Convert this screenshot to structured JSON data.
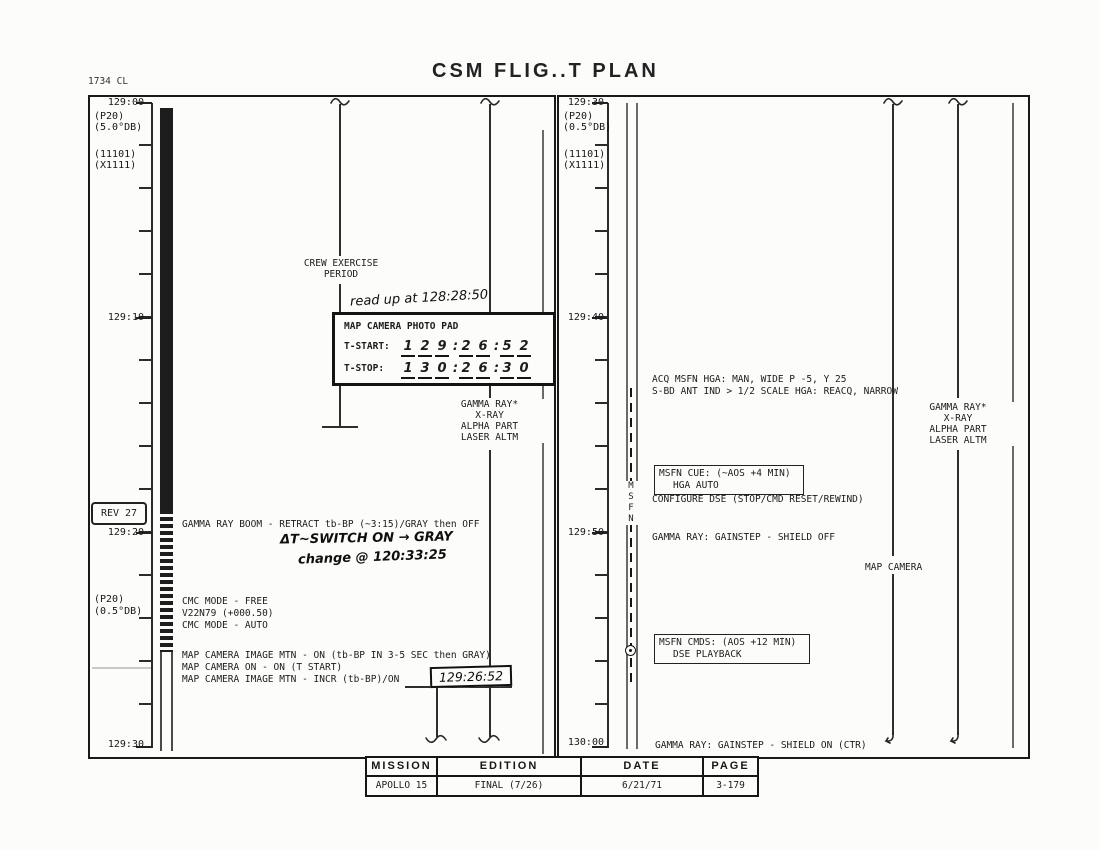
{
  "colors": {
    "ink": "#1c1c1c",
    "paper": "#fcfcfa"
  },
  "header": {
    "corner_code": "1734 CL",
    "title": "CSM FLIG..T PLAN"
  },
  "left_panel": {
    "time_labels": [
      "129:00",
      "129:10",
      "129:20",
      "129:30"
    ],
    "top_codes": [
      "(P20)",
      "(5.0°DB)",
      "(11101)",
      "(X1111)"
    ],
    "bottom_codes": [
      "(P20)",
      "(0.5°DB)"
    ],
    "rev_badge": "REV 27",
    "crew_exercise_lines": [
      "CREW EXERCISE",
      "PERIOD"
    ],
    "hw_read_up": "read up at 128:28:50",
    "photo_pad": {
      "title": "MAP CAMERA PHOTO PAD",
      "t_start_label": "T-START:",
      "t_stop_label": "T-STOP:",
      "t_start": [
        "1",
        "2",
        "9",
        ":",
        "2",
        "6",
        ":",
        "5",
        "2"
      ],
      "t_stop": [
        "1",
        "3",
        "0",
        ":",
        "2",
        "6",
        ":",
        "3",
        "0"
      ]
    },
    "instruments": [
      "GAMMA RAY*",
      "X-RAY",
      "ALPHA PART",
      "LASER ALTM"
    ],
    "gamma_boom_line": "GAMMA RAY BOOM - RETRACT tb-BP (~3:15)/GRAY then OFF",
    "hw_switch_note": "ΔT~SWITCH ON → GRAY",
    "hw_change_note": "change @ 120:33:25",
    "cmc_lines": [
      "CMC MODE - FREE",
      "V22N79 (+000.50)",
      "CMC MODE - AUTO"
    ],
    "map_camera_lines": [
      "MAP CAMERA IMAGE MTN - ON (tb-BP IN 3-5 SEC then GRAY)",
      "MAP CAMERA ON - ON (T START)",
      "MAP CAMERA IMAGE MTN - INCR (tb-BP)/ON"
    ],
    "hw_incr_time": "129:26:52"
  },
  "right_panel": {
    "time_labels": [
      "129:30",
      "129:40",
      "129:50",
      "130:00"
    ],
    "top_codes": [
      "(P20)",
      "(0.5°DB)",
      "(11101)",
      "(X1111)"
    ],
    "msfn_letters": [
      "M",
      "S",
      "F",
      "N"
    ],
    "acq_lines": [
      "ACQ MSFN HGA: MAN, WIDE P -5, Y 25",
      "S-BD ANT IND > 1/2 SCALE HGA: REACQ, NARROW"
    ],
    "msfn_cue_lines": [
      "MSFN CUE: (~AOS +4 MIN)",
      "HGA AUTO"
    ],
    "configure_dse": "CONFIGURE DSE (STOP/CMD RESET/REWIND)",
    "gamma_gainstep_off": "GAMMA RAY: GAINSTEP - SHIELD OFF",
    "map_camera_label": "MAP CAMERA",
    "msfn_cmds_lines": [
      "MSFN CMDS: (AOS +12 MIN)",
      "DSE PLAYBACK"
    ],
    "gamma_gainstep_on": "GAMMA RAY: GAINSTEP - SHIELD ON (CTR)",
    "instruments": [
      "GAMMA RAY*",
      "X-RAY",
      "ALPHA PART",
      "LASER ALTM"
    ]
  },
  "footer": {
    "headers": [
      "MISSION",
      "EDITION",
      "DATE",
      "PAGE"
    ],
    "values": [
      "APOLLO 15",
      "FINAL (7/26)",
      "6/21/71",
      "3-179"
    ]
  }
}
